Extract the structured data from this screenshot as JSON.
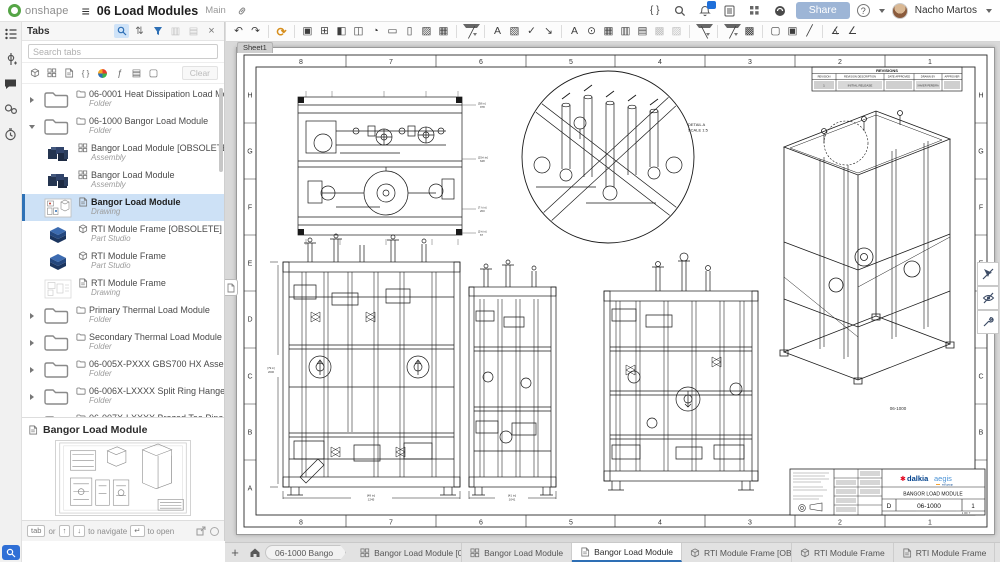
{
  "header": {
    "logo_text": "onshape",
    "title": "06 Load Modules",
    "branch": "Main",
    "share_label": "Share",
    "user_name": "Nacho Martos",
    "icons": {
      "featurescript": "{ }",
      "help": "?"
    }
  },
  "toolbar": [
    {
      "n": "undo-icon",
      "g": "↶",
      "cls": "",
      "i": "true"
    },
    {
      "n": "redo-icon",
      "g": "↷",
      "cls": "",
      "i": "true"
    },
    {
      "n": "toolbar-divider",
      "g": "",
      "cls": "divider",
      "i": "false"
    },
    {
      "n": "update-references-icon",
      "g": "⟳",
      "cls": "orange",
      "i": "true"
    },
    {
      "n": "toolbar-divider",
      "g": "",
      "cls": "divider",
      "i": "false"
    },
    {
      "n": "insert-view-icon",
      "g": "▣",
      "cls": "",
      "i": "true"
    },
    {
      "n": "projected-view-icon",
      "g": "⊞",
      "cls": "",
      "i": "true"
    },
    {
      "n": "auxiliary-view-icon",
      "g": "◧",
      "cls": "",
      "i": "true"
    },
    {
      "n": "section-view-icon",
      "g": "◫",
      "cls": "",
      "i": "true"
    },
    {
      "n": "detail-view-icon",
      "g": "◔",
      "cls": "",
      "i": "true"
    },
    {
      "n": "crop-view-icon",
      "g": "▭",
      "cls": "",
      "i": "true"
    },
    {
      "n": "break-view-icon",
      "g": "▯",
      "cls": "",
      "i": "true"
    },
    {
      "n": "broken-out-section-icon",
      "g": "▨",
      "cls": "",
      "i": "true"
    },
    {
      "n": "show-hidden-edges-icon",
      "g": "▦",
      "cls": "",
      "i": "true"
    },
    {
      "n": "toolbar-divider",
      "g": "",
      "cls": "divider",
      "i": "false"
    },
    {
      "n": "dimension-icon",
      "g": "╱",
      "cls": "caret",
      "i": "true"
    },
    {
      "n": "toolbar-divider",
      "g": "",
      "cls": "divider",
      "i": "false"
    },
    {
      "n": "note-icon",
      "g": "A",
      "cls": "",
      "i": "true"
    },
    {
      "n": "image-icon",
      "g": "▧",
      "cls": "",
      "i": "true"
    },
    {
      "n": "check-icon",
      "g": "✓",
      "cls": "",
      "i": "true"
    },
    {
      "n": "callout-icon",
      "g": "↘",
      "cls": "",
      "i": "true"
    },
    {
      "n": "toolbar-divider",
      "g": "",
      "cls": "divider",
      "i": "false"
    },
    {
      "n": "text-icon",
      "g": "A",
      "cls": "",
      "i": "true"
    },
    {
      "n": "zoom-annotation-icon",
      "g": "⊙",
      "cls": "",
      "i": "true"
    },
    {
      "n": "table-icon",
      "g": "▦",
      "cls": "",
      "i": "true"
    },
    {
      "n": "hole-table-icon",
      "g": "▥",
      "cls": "",
      "i": "true"
    },
    {
      "n": "bom-table-icon",
      "g": "▤",
      "cls": "",
      "i": "true"
    },
    {
      "n": "revision-table-icon",
      "g": "▩",
      "cls": "grayed",
      "i": "true"
    },
    {
      "n": "weld-table-icon",
      "g": "▨",
      "cls": "grayed",
      "i": "true"
    },
    {
      "n": "toolbar-divider",
      "g": "",
      "cls": "divider",
      "i": "false"
    },
    {
      "n": "centerline-icon",
      "g": "╲",
      "cls": "caret",
      "i": "true"
    },
    {
      "n": "toolbar-divider",
      "g": "",
      "cls": "divider",
      "i": "false"
    },
    {
      "n": "line-icon",
      "g": "╱",
      "cls": "caret",
      "i": "true"
    },
    {
      "n": "hatch-icon",
      "g": "▩",
      "cls": "",
      "i": "true"
    },
    {
      "n": "toolbar-divider",
      "g": "",
      "cls": "divider",
      "i": "false"
    },
    {
      "n": "new-sheet-icon",
      "g": "▢",
      "cls": "",
      "i": "true"
    },
    {
      "n": "manage-sheets-icon",
      "g": "▣",
      "cls": "",
      "i": "true"
    },
    {
      "n": "edit-border-icon",
      "g": "╱",
      "cls": "",
      "i": "true"
    },
    {
      "n": "toolbar-divider",
      "g": "",
      "cls": "divider",
      "i": "false"
    },
    {
      "n": "measure-distance-icon",
      "g": "∡",
      "cls": "",
      "i": "true"
    },
    {
      "n": "measure-angle-icon",
      "g": "∠",
      "cls": "",
      "i": "true"
    }
  ],
  "sidebar": {
    "title": "Tabs",
    "search_placeholder": "Search tabs",
    "clear_label": "Clear",
    "items": [
      {
        "cls": "folder collapsed",
        "label": "06-0001 Heat Dissipation Load Mod...",
        "sublabel": "Folder"
      },
      {
        "cls": "folder expanded",
        "label": "06-1000 Bangor Load Module",
        "sublabel": "Folder"
      },
      {
        "cls": "child assembly",
        "label": "Bangor Load Module [OBSOLETE]",
        "sublabel": "Assembly"
      },
      {
        "cls": "child assembly",
        "label": "Bangor Load Module",
        "sublabel": "Assembly"
      },
      {
        "cls": "child drawing selected",
        "label": "Bangor Load Module",
        "sublabel": "Drawing"
      },
      {
        "cls": "child partstudio",
        "label": "RTI Module Frame [OBSOLETE]",
        "sublabel": "Part Studio"
      },
      {
        "cls": "child partstudio",
        "label": "RTI Module Frame",
        "sublabel": "Part Studio"
      },
      {
        "cls": "child drawinglight",
        "label": "RTI Module Frame",
        "sublabel": "Drawing"
      },
      {
        "cls": "folder collapsed",
        "label": "Primary Thermal Load Module",
        "sublabel": "Folder"
      },
      {
        "cls": "folder collapsed",
        "label": "Secondary Thermal Load Module",
        "sublabel": "Folder"
      },
      {
        "cls": "folder collapsed",
        "label": "06-005X-PXXX GBS700 HX Assembly",
        "sublabel": "Folder"
      },
      {
        "cls": "folder collapsed",
        "label": "06-006X-LXXXX Split Ring Hanger A...",
        "sublabel": "Folder"
      },
      {
        "cls": "folder collapsed",
        "label": "06-007X-LXXXX Brazed Tee Pipe As...",
        "sublabel": "Folder"
      }
    ],
    "preview_title": "Bangor Load Module",
    "footer": {
      "key_tab": "tab",
      "or_label": "or",
      "key_up": "↑",
      "key_down": "↓",
      "navigate_label": "to navigate",
      "key_enter": "↵",
      "open_label": "to open"
    }
  },
  "sheet": {
    "tab": "Sheet1",
    "cols": [
      "8",
      "7",
      "6",
      "5",
      "4",
      "3",
      "2",
      "1"
    ],
    "rows": [
      "H",
      "G",
      "F",
      "E",
      "D",
      "C",
      "B",
      "A"
    ],
    "detail": {
      "line1": "DETAIL A",
      "line2": "SCALE 1:5"
    },
    "iso_label": "06-1000",
    "revisions": {
      "title": "REVISIONS",
      "headers": [
        "REVISION",
        "REVISION DESCRIPTION",
        "DATE APPROVED",
        "DRAWN BY",
        "APPROVER"
      ],
      "row": {
        "rev": "1",
        "desc": "INITIAL RELEASE",
        "drawn_by": "XAVIER PEREIRA"
      }
    },
    "titleblock": {
      "brand_star": "✱",
      "brand_a": "dalkia",
      "brand_b": "aegis",
      "brand_sub": "edf group",
      "title": "BANGOR LOAD MODULE",
      "size": "D",
      "number": "06-1000",
      "rev": "1",
      "sheet_note": "1 OF 7"
    },
    "dims": {
      "v1_w": {
        "a": "[49 in]",
        "b": "1245"
      },
      "v2_w": {
        "a": "[41 in]",
        "b": "1041"
      },
      "v1_h": {
        "a": "[79 in]",
        "b": "2006"
      },
      "tv_r1": {
        "a": "[38 in]",
        "b": "978"
      },
      "tv_r2": {
        "a": "[25⅝ in]",
        "b": "648"
      },
      "tv_r3": {
        "a": "[7⅞ in]",
        "b": "200"
      },
      "tv_r4": {
        "a": "[2⅝ in]",
        "b": "67"
      }
    }
  },
  "docbar": {
    "breadcrumb": "06-1000 Bango",
    "tabs": [
      {
        "cls": "assembly",
        "label": "Bangor Load Module [0...",
        "i": "true"
      },
      {
        "cls": "assembly",
        "label": "Bangor Load Module",
        "i": "true"
      },
      {
        "cls": "drawing active",
        "label": "Bangor Load Module",
        "i": "true"
      },
      {
        "cls": "partstudio",
        "label": "RTI Module Frame [OB...",
        "i": "true"
      },
      {
        "cls": "partstudio",
        "label": "RTI Module Frame",
        "i": "true"
      },
      {
        "cls": "drawing",
        "label": "RTI Module Frame",
        "i": "true"
      }
    ]
  }
}
